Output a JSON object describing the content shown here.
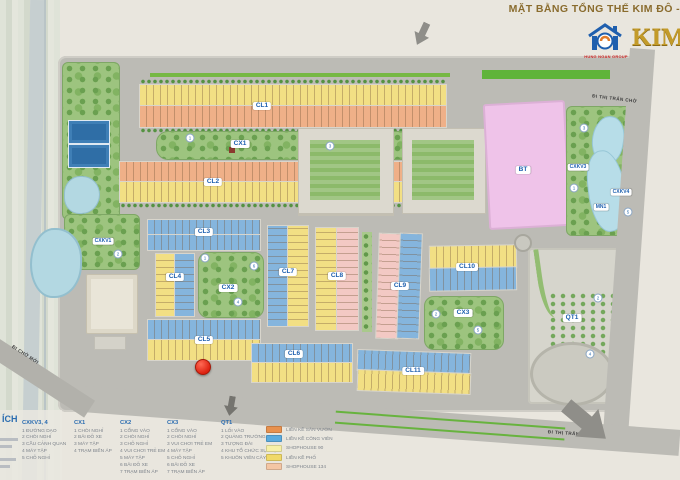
{
  "header": {
    "title": "MẶT BẰNG TỔNG THỂ KIM ĐÔ -",
    "logo_group": "HUNG NGAN GROUP",
    "logo_brand": "KIM"
  },
  "roads": {
    "north": "ĐI THỊ TRẤN CHỜ",
    "south": "ĐI THỊ TRẤN CHỜ",
    "southwest": "ĐI CHỜ MỚI"
  },
  "blocks": {
    "cl1": "CL1",
    "cl2": "CL2",
    "cl3": "CL3",
    "cl4": "CL4",
    "cl5": "CL5",
    "cl6": "CL6",
    "cl7": "CL7",
    "cl8": "CL8",
    "cl9": "CL9",
    "cl10": "CL10",
    "cl11": "CL11",
    "cx1": "CX1",
    "cx2": "CX2",
    "cx3": "CX3",
    "qt1": "QT1",
    "bt": "BT",
    "mn1": "MN1",
    "cxkv1": "CXKV1",
    "cxkv3": "CXKV3",
    "cxkv4": "CXKV4"
  },
  "colors": {
    "townhouse_garden": "#e8914e",
    "townhouse_park": "#5aabdf",
    "shophouse_90": "#f6f0a8",
    "townhouse_street": "#f0d968",
    "shophouse_134": "#f4c6a4",
    "villa_pink": "#efc3e9",
    "lake_blue": "#b7dde8",
    "park_green": "#9dc47f"
  },
  "legend": {
    "cut_header": "ÍCH",
    "columns": [
      {
        "header": "CXKV3, 4",
        "items": [
          "1  ĐƯỜNG DẠO",
          "2  CHÒI NGHỈ",
          "3  CẦU CẢNH QUAN",
          "4  MÁY TẬP",
          "5  CHỖ NGHỈ"
        ]
      },
      {
        "header": "CX1",
        "items": [
          "1  CHÒI NGHỈ",
          "2  BÃI ĐỖ XE",
          "3  MÁY TẬP",
          "4  TRẠM BIẾN ÁP"
        ]
      },
      {
        "header": "CX2",
        "items": [
          "1  CỔNG VÀO",
          "2  CHÒI NGHỈ",
          "3  CHỖ NGHỈ",
          "4  VUI CHƠI TRẺ EM",
          "5  MÁY TẬP",
          "6  BÃI ĐỖ XE",
          "7  TRẠM BIẾN ÁP"
        ]
      },
      {
        "header": "CX3",
        "items": [
          "1  CỔNG VÀO",
          "2  CHÒI NGHỈ",
          "3  VUI CHƠI TRẺ EM",
          "4  MÁY TẬP",
          "5  CHỖ NGHỈ",
          "6  BÃI ĐỖ XE",
          "7  TRẠM BIẾN ÁP"
        ]
      },
      {
        "header": "QT1",
        "items": [
          "1  LỐI VÀO",
          "2  QUẢNG TRƯỜNG",
          "3  TƯỢNG ĐÀI",
          "4  KHU TỔ CHỨC SỰ KIỆN",
          "5  KHUÔN VIÊN CÂY XANH"
        ]
      }
    ],
    "swatches": [
      {
        "color": "#e8914e",
        "label": "LIỀN KỀ SÂN VƯỜN"
      },
      {
        "color": "#5aabdf",
        "label": "LIỀN KỀ CÔNG VIÊN"
      },
      {
        "color": "#f6f0a8",
        "label": "SHOPHOUSE 90"
      },
      {
        "color": "#f0d968",
        "label": "LIỀN KỀ PHỐ"
      },
      {
        "color": "#f4c6a4",
        "label": "SHOPHOUSE 134"
      }
    ]
  },
  "markers": [
    "2",
    "1",
    "3",
    "1",
    "4",
    "6",
    "2",
    "5",
    "2",
    "4",
    "3",
    "1",
    "5"
  ]
}
